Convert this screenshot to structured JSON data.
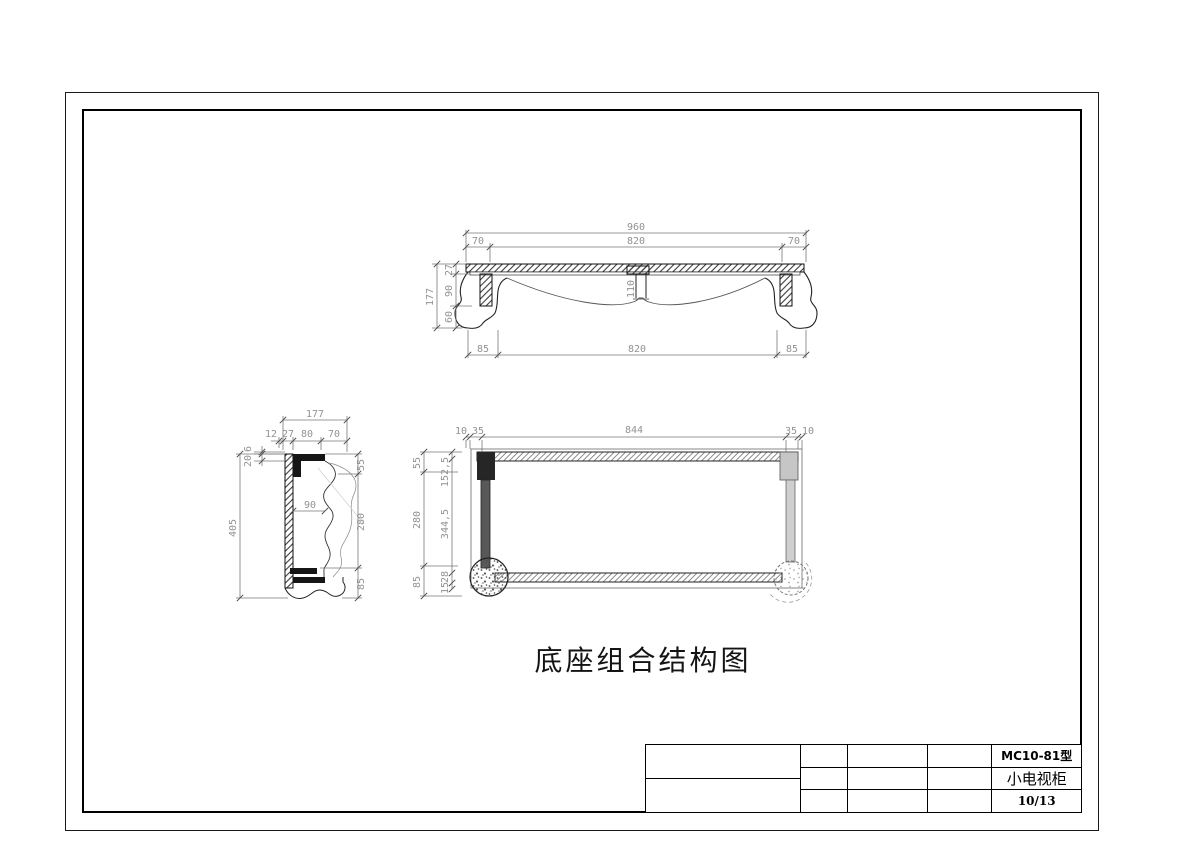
{
  "view_title": "底座组合结构图",
  "title_block": {
    "model": "MC10-81型",
    "product_name": "小电视柜",
    "page_number": "10/13"
  },
  "front_view": {
    "total_width": "960",
    "top_width": "820",
    "top_left_overhang": "70",
    "top_right_overhang": "70",
    "height_total": "177",
    "height_top": "27",
    "height_mid": "90",
    "height_bottom": "60",
    "center_leg_width": "110",
    "bottom_left_foot": "85",
    "bottom_span": "820",
    "bottom_right_foot": "85"
  },
  "side_view": {
    "depth_total": "177",
    "front_edge": "12",
    "seg_a": "27",
    "seg_b": "80",
    "seg_c": "70",
    "top_small_a": "6",
    "top_small_b": "20",
    "height_total": "405",
    "mid_span": "90",
    "right_top": "55",
    "right_mid": "280",
    "right_bottom": "85"
  },
  "plan_view": {
    "edge_left": "10",
    "leg_left": "35",
    "inner_span": "844",
    "leg_right": "35",
    "edge_right": "10",
    "outer_top": "55",
    "outer_mid": "280",
    "outer_bottom": "85",
    "inner_top": "152,5",
    "inner_mid": "344,5",
    "inner_bottom_a": "28",
    "inner_bottom_b": "15"
  }
}
